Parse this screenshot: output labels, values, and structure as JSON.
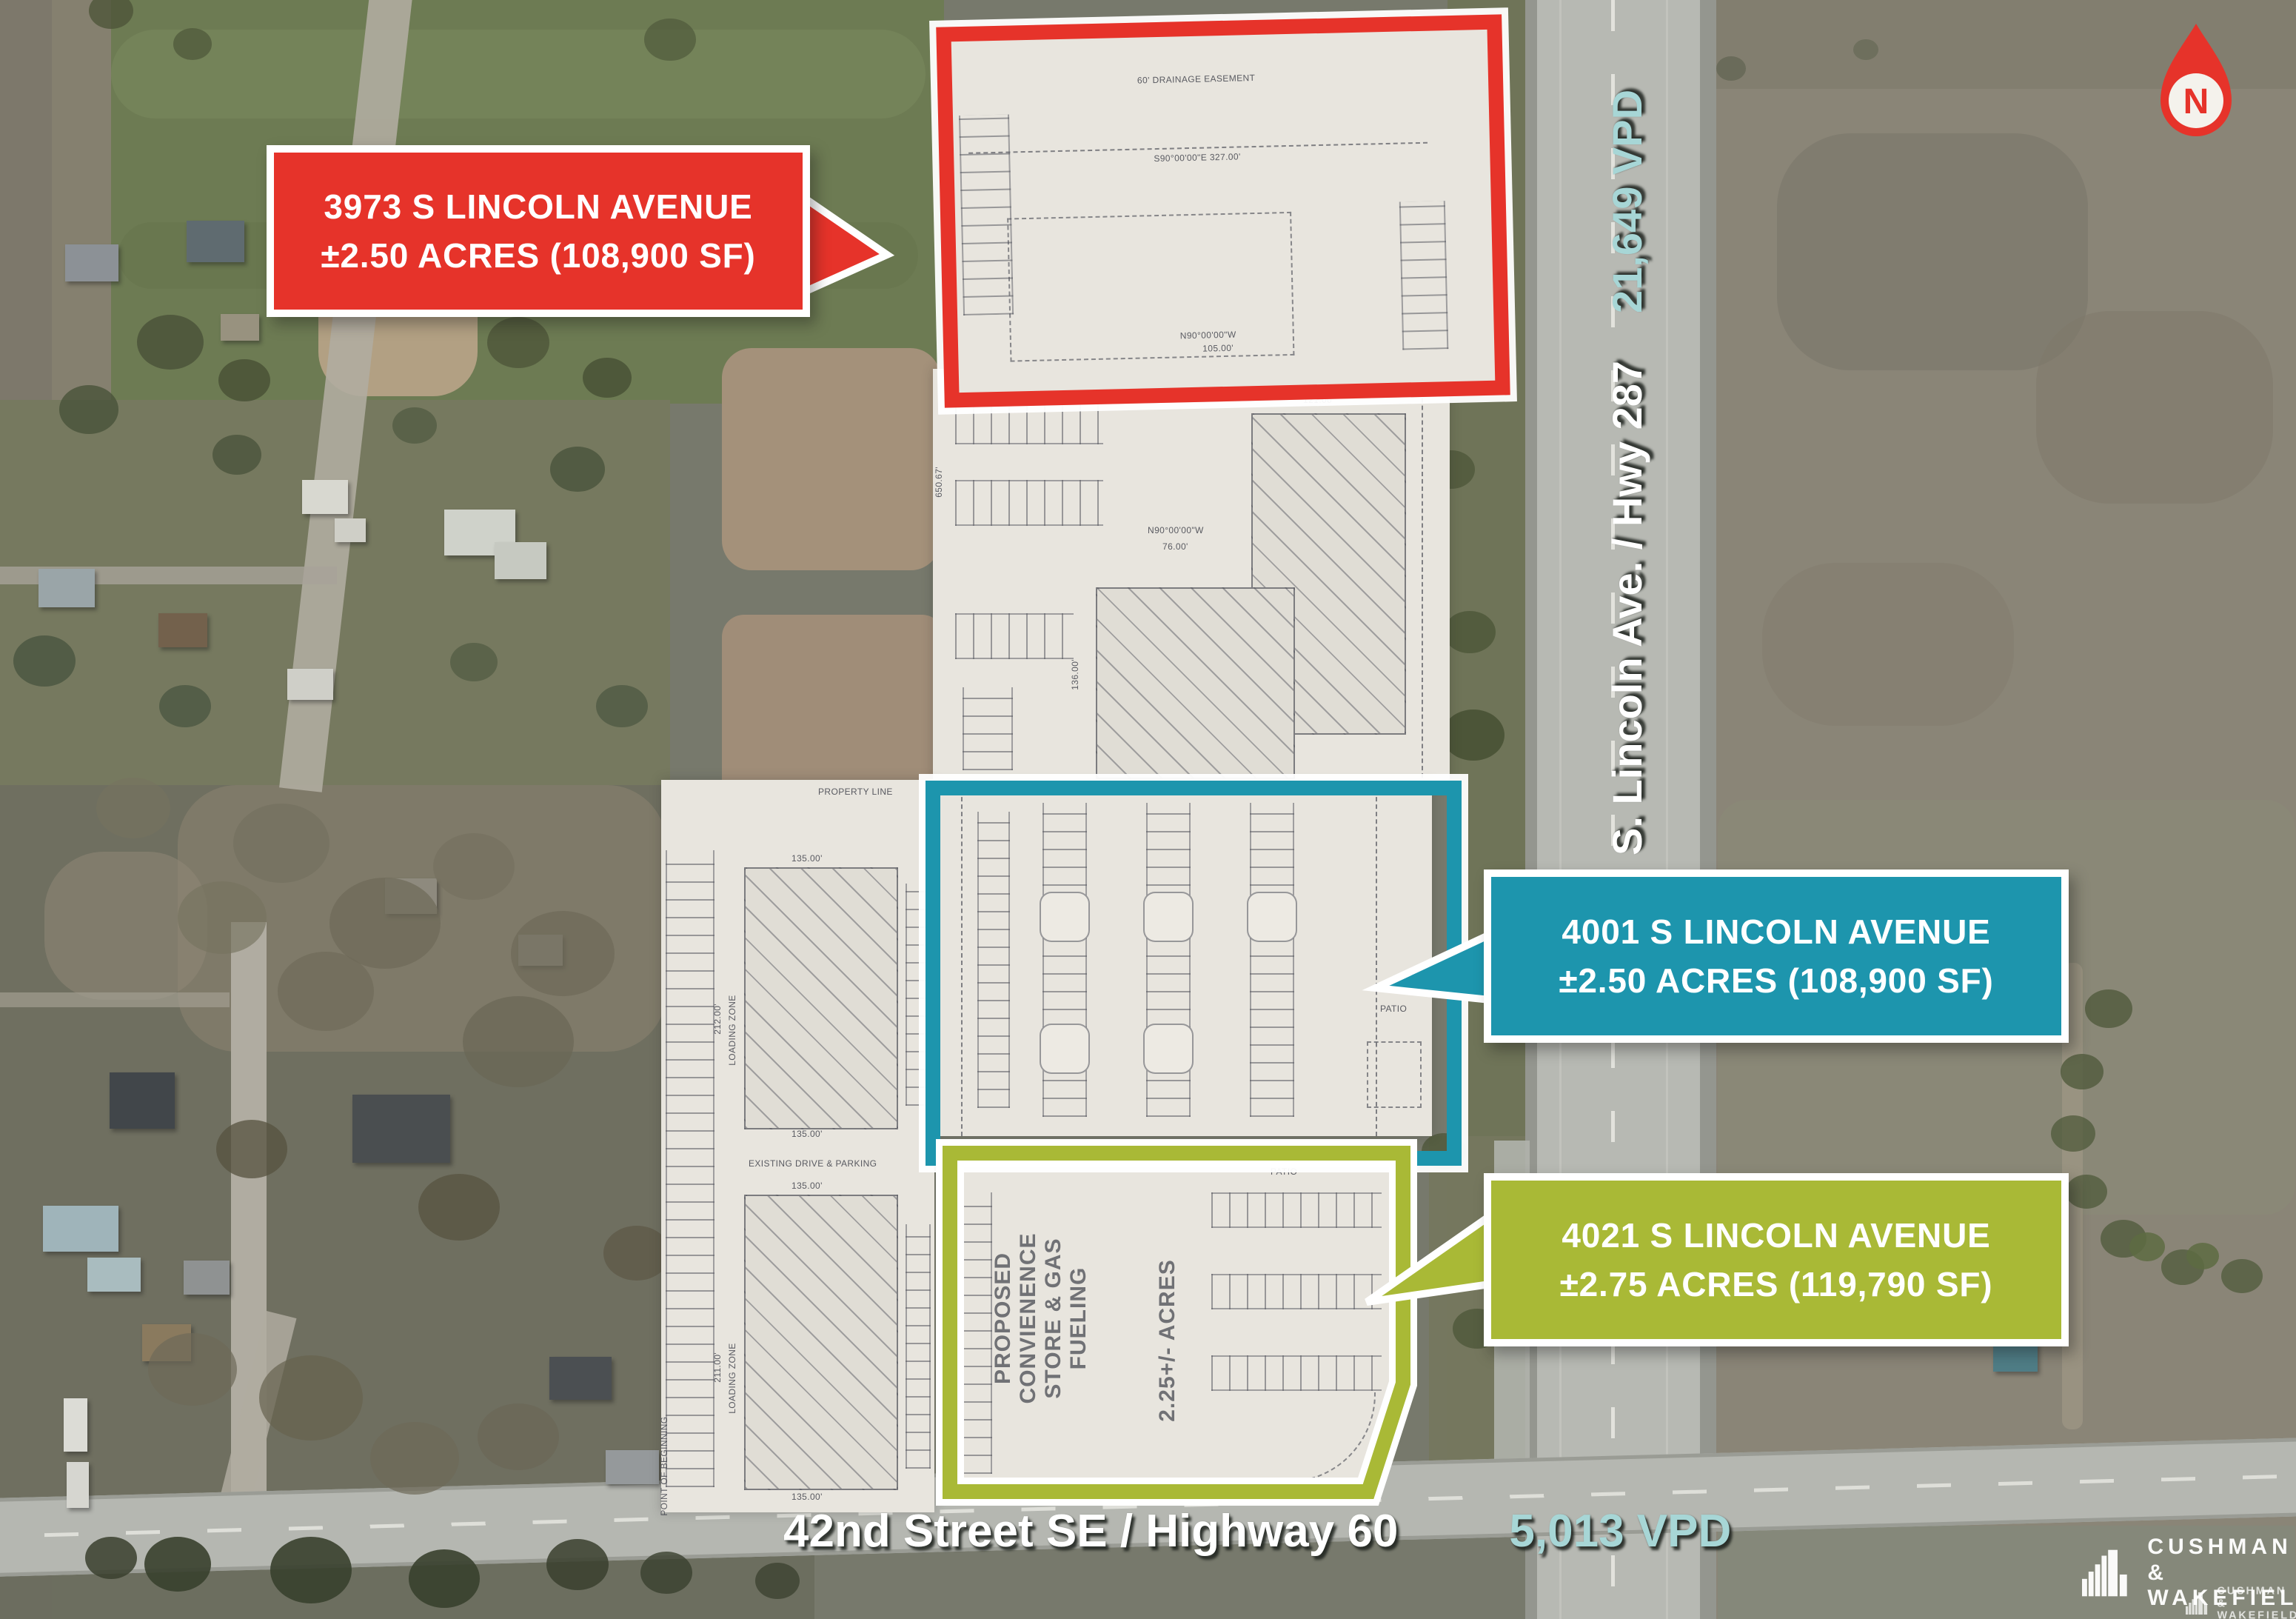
{
  "parcels": [
    {
      "address_line": "3973 S LINCOLN AVENUE",
      "size_line": "±2.50 ACRES (108,900 SF)",
      "color": "#e6332a"
    },
    {
      "address_line": "4001 S LINCOLN AVENUE",
      "size_line": "±2.50 ACRES (108,900 SF)",
      "color": "#1d95ad"
    },
    {
      "address_line": "4021 S LINCOLN AVENUE",
      "size_line": "±2.75 ACRES (119,790 SF)",
      "color": "#a9b936"
    }
  ],
  "roads": {
    "vertical": {
      "name": "S. Lincoln Ave. / Hwy 287",
      "vpd": "21,649 VPD"
    },
    "horizontal": {
      "name": "42nd Street SE / Highway 60",
      "vpd": "5,013 VPD"
    }
  },
  "north_arrow": {
    "label": "N"
  },
  "logo": {
    "line1": "CUSHMAN &",
    "line2": "WAKEFIELD"
  },
  "site_plan": {
    "drainage_easement": "60' DRAINAGE EASEMENT",
    "property_line": "PROPERTY LINE",
    "point_of_beginning": "POINT OF BEGINNING",
    "existing_drive": "EXISTING DRIVE & PARKING",
    "loading_zone": "LOADING ZONE",
    "proposed_store_col1": "PROPOSED",
    "proposed_store_col2": "CONVIENENCE",
    "proposed_store_col3": "STORE & GAS FUELING",
    "proposed_acres": "2.25+/- ACRES",
    "patio": "PATIO",
    "dim_327": "S90°00'00\"E   327.00'",
    "dim_105": "105.00'",
    "dim_121": "121.00'",
    "dim_76": "76.00'",
    "dim_136": "136.00'",
    "dim_135": "135.00'",
    "dim_212": "212.00'",
    "dim_211": "211.00'",
    "dim_650": "650.67'",
    "dim_n90": "N90°00'00\"W",
    "bearing_105": "N89°25'08\"W  105.03'"
  },
  "colors": {
    "red": "#e6332a",
    "teal": "#1d95ad",
    "green": "#a9b936",
    "vpd_text": "#a7d6d6"
  }
}
